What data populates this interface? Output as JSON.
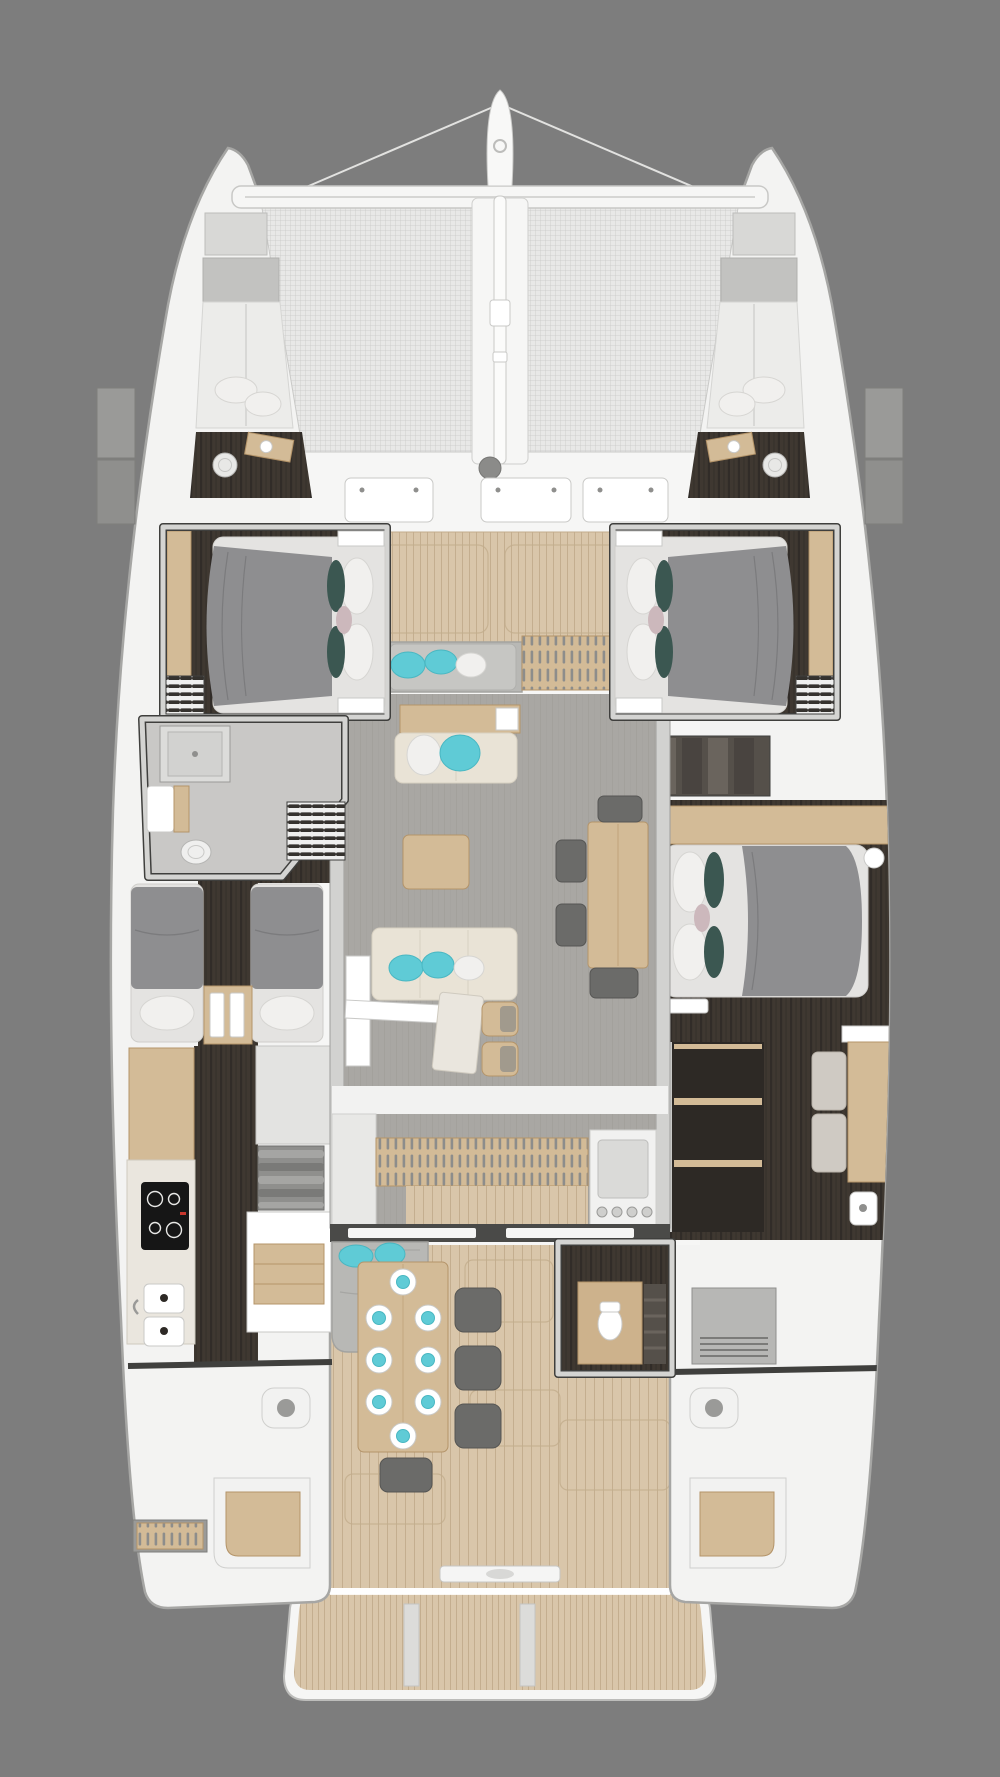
{
  "colors": {
    "bg": "#7d7d7d",
    "hull": "#f3f3f2",
    "hullStroke": "#a6a6a4",
    "deck": "#f6f6f5",
    "wallLight": "#d4d4d2",
    "wallDark": "#3f3f3d",
    "tramp": "#e8e8e7",
    "trampGrid": "#c9c9c7",
    "teak": "#d9c6aa",
    "teakLine": "#c2ac8c",
    "salon": "#a9a7a3",
    "salonLine": "#9b9995",
    "darkFloor": "#3f3831",
    "darkFloor2": "#2d2925",
    "wood": "#d3bb97",
    "woodDark": "#b49469",
    "marble": "#eae6de",
    "mattress": "#e4e3e1",
    "duvet": "#8e8e90",
    "pillowWhite": "#f1f0ee",
    "teal": "#3b5751",
    "pink": "#ccb8bc",
    "aqua": "#5fcbd6",
    "cream": "#e9e3d6",
    "lounge": "#b8b8b5",
    "chair": "#6b6b69",
    "gray1": "#c9c9c7",
    "gray2": "#8f8f8d",
    "cooktop": "#161616",
    "white": "#ffffff"
  },
  "inventory": {
    "hulls": 2,
    "double_cabins": 3,
    "twin_cabin": 1,
    "bow_berths": 2,
    "bathrooms": 4,
    "cockpit_place_settings": 8,
    "foredeck_hatches": 3
  }
}
